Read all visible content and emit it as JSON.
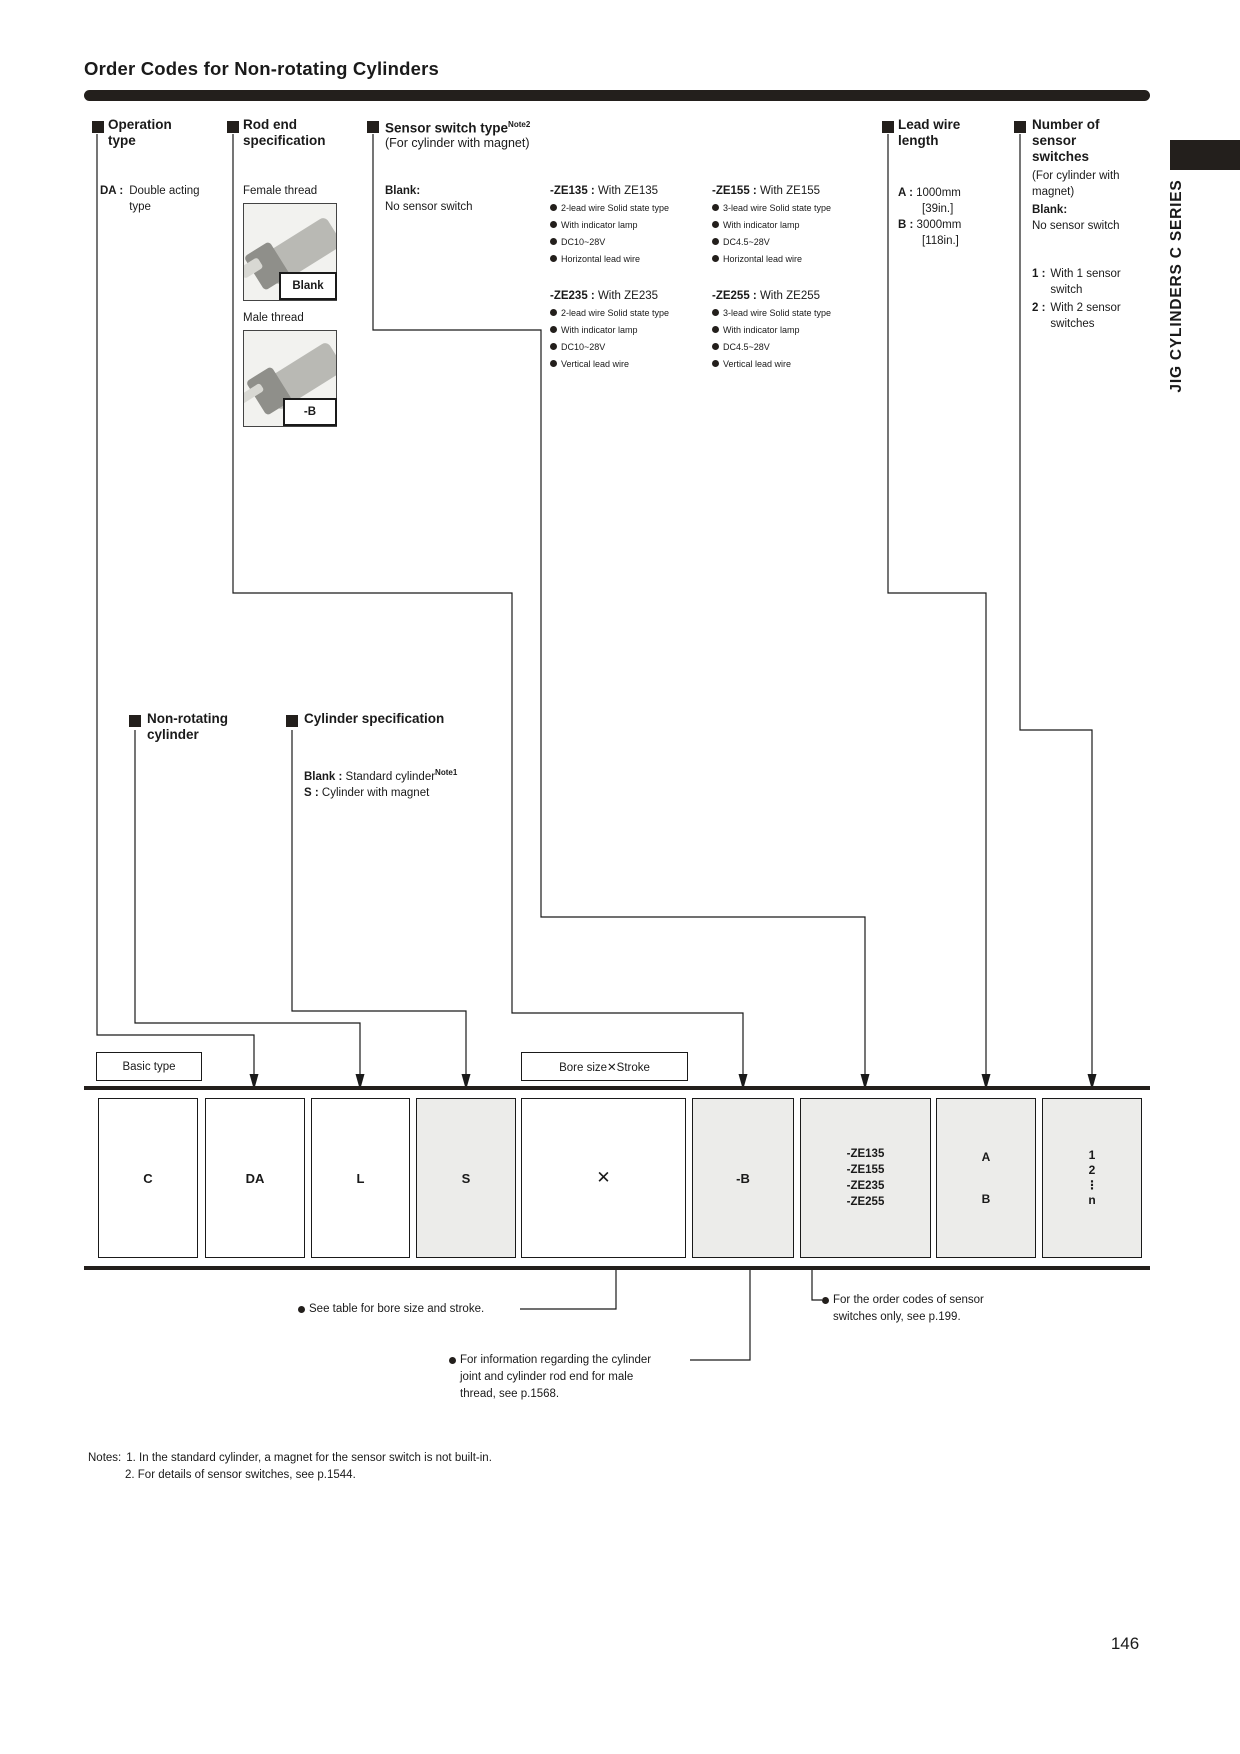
{
  "page": {
    "title": "Order Codes for Non-rotating Cylinders",
    "sidebar_tab": "JIG CYLINDERS C SERIES",
    "page_number": "146",
    "accent_color": "#231f1c",
    "box_fill_color": "#ececea"
  },
  "columns": {
    "operation": {
      "title": "Operation\ntype",
      "item_code": "DA :",
      "item_desc": "Double acting\ntype"
    },
    "rod_end": {
      "title": "Rod end\nspecification",
      "female_label": "Female thread",
      "female_code": "Blank",
      "male_label": "Male thread",
      "male_code": "-B"
    },
    "sensor": {
      "title": "Sensor switch type",
      "note_ref": "Note2",
      "subtitle": "(For cylinder with magnet)",
      "blank_code": "Blank:",
      "blank_desc": "No sensor switch",
      "groups": [
        {
          "code": "-ZE135 :",
          "name": "With ZE135",
          "features": [
            "2-lead wire Solid state type",
            "With indicator lamp",
            "DC10~28V",
            "Horizontal lead wire"
          ]
        },
        {
          "code": "-ZE235 :",
          "name": "With ZE235",
          "features": [
            "2-lead wire Solid state type",
            "With indicator lamp",
            "DC10~28V",
            "Vertical lead wire"
          ]
        },
        {
          "code": "-ZE155 :",
          "name": "With ZE155",
          "features": [
            "3-lead wire Solid state type",
            "With indicator lamp",
            "DC4.5~28V",
            "Horizontal lead wire"
          ]
        },
        {
          "code": "-ZE255 :",
          "name": "With ZE255",
          "features": [
            "3-lead wire Solid state type",
            "With indicator lamp",
            "DC4.5~28V",
            "Vertical lead wire"
          ]
        }
      ]
    },
    "lead_wire": {
      "title": "Lead wire\nlength",
      "items": [
        {
          "code": "A :",
          "value": "1000mm",
          "inch": "[39in.]"
        },
        {
          "code": "B :",
          "value": "3000mm",
          "inch": "[118in.]"
        }
      ]
    },
    "sensor_count": {
      "title": "Number of\nsensor\nswitches",
      "subtitle": "(For cylinder with\nmagnet)",
      "blank_code": "Blank:",
      "blank_desc": "No sensor switch",
      "items": [
        {
          "code": "1 :",
          "desc": "With 1 sensor\nswitch"
        },
        {
          "code": "2 :",
          "desc": "With 2 sensor\nswitches"
        }
      ]
    },
    "non_rotating": {
      "title": "Non-rotating\ncylinder"
    },
    "cyl_spec": {
      "title": "Cylinder specification",
      "blank_code": "Blank :",
      "blank_desc": "Standard cylinder",
      "blank_note": "Note1",
      "s_code": "S :",
      "s_desc": "Cylinder with magnet"
    }
  },
  "code_row": {
    "basic_type_label": "Basic type",
    "bore_label": "Bore size✕Stroke",
    "boxes": {
      "basic": "C",
      "operation": "DA",
      "non_rotating": "L",
      "cyl_spec": "S",
      "bore": "✕",
      "rod_end": "-B",
      "sensor": [
        "-ZE135",
        "-ZE155",
        "-ZE235",
        "-ZE255"
      ],
      "lead": [
        "A",
        "B"
      ],
      "count": [
        "1",
        "2",
        "⋮",
        "n"
      ]
    }
  },
  "footnotes": {
    "bore": "See table for bore size and stroke.",
    "rod": "For information regarding the cylinder\njoint and cylinder rod end for male\nthread, see p.1568.",
    "sensor": "For the order codes of sensor\nswitches only, see p.199."
  },
  "notes": {
    "label": "Notes:",
    "line1": "1. In the standard cylinder, a magnet for the sensor switch is not built-in.",
    "line2": "2. For details of sensor switches, see p.1544."
  }
}
